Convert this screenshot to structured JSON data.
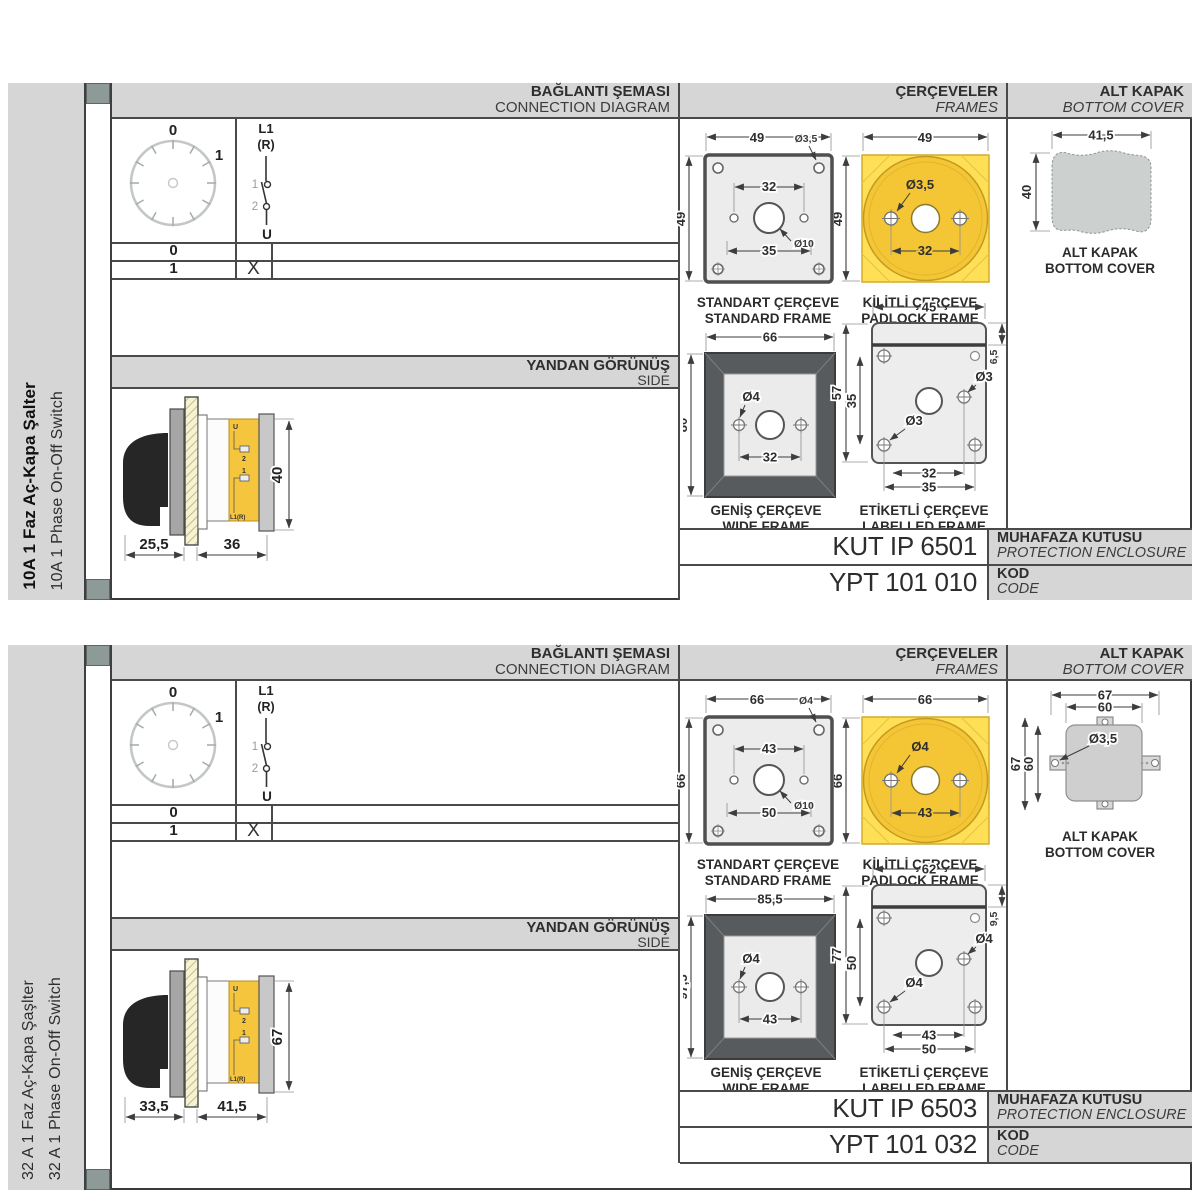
{
  "colors": {
    "accent_yellow": "#f4c636",
    "panel_gray": "#d6d6d6",
    "strip_slate": "#8e9a98",
    "line_dark": "#3f3f3f"
  },
  "sections": [
    {
      "sidebar": {
        "title_tr": "10A 1 Faz Aç-Kapa Şalter",
        "title_en": "10A 1 Phase On-Off Switch",
        "title_bold": true
      },
      "headers": {
        "connection_tr": "BAĞLANTI ŞEMASI",
        "connection_en": "CONNECTION DIAGRAM",
        "frames_tr": "ÇERÇEVELER",
        "frames_en": "FRAMES",
        "cover_tr": "ALT KAPAK",
        "cover_en": "BOTTOM COVER",
        "side_tr": "YANDAN GÖRÜNÜŞ",
        "side_en": "SIDE"
      },
      "diagram": {
        "dial": {
          "pos0": "0",
          "pos1": "1"
        },
        "switch": {
          "top": "L1",
          "top2": "(R)",
          "c1": "1",
          "c2": "2",
          "bottom": "U"
        },
        "table": [
          {
            "pos": "0",
            "mark": ""
          },
          {
            "pos": "1",
            "mark": "X"
          }
        ]
      },
      "side_view": {
        "dim_handle": "25,5",
        "dim_depth": "36",
        "dim_height": "40",
        "labels": {
          "u": "U",
          "t2": "2",
          "t1": "1",
          "l1r": "L1(R)"
        }
      },
      "frames": {
        "standard": {
          "caption_tr": "STANDART ÇERÇEVE",
          "caption_en": "STANDARD FRAME",
          "dim_width": "49",
          "dim_height": "49",
          "screw_dia": "Ø3,5",
          "dim_holes": "32",
          "center_dia": "Ø10",
          "dim_outer_holes": "35"
        },
        "padlock": {
          "caption_tr": "KİLİTLİ ÇERÇEVE",
          "caption_en": "PADLOCK FRAME",
          "dim_width": "49",
          "dim_height": "49",
          "screw_dia": "Ø3,5",
          "dim_holes": "32"
        },
        "wide": {
          "caption_tr": "GENİŞ ÇERÇEVE",
          "caption_en": "WIDE FRAME",
          "dim_width": "66",
          "dim_height": "80",
          "screw_dia": "Ø4",
          "dim_holes": "32"
        },
        "labelled": {
          "caption_tr": "ETİKETLİ ÇERÇEVE",
          "caption_en": "LABELLED FRAME",
          "dim_width": "45",
          "dim_strip": "6,5",
          "dim_height": "57",
          "dim_holes_v": "35",
          "screw_dia_right": "Ø3",
          "screw_dia_left": "Ø3",
          "dim_holes": "32",
          "dim_outer_holes": "35"
        }
      },
      "bottom_cover": {
        "variant": 1,
        "caption_tr": "ALT KAPAK",
        "caption_en": "BOTTOM COVER",
        "dim_width": "41,5",
        "dim_height": "40",
        "dim_width_outer": "",
        "dim_width_inner": "",
        "dim_height_outer": "",
        "dim_height_inner": "",
        "screw_dia": ""
      },
      "codes": {
        "enclosure_value": "KUT IP 6501",
        "enclosure_label_tr": "MUHAFAZA KUTUSU",
        "enclosure_label_en": "PROTECTION ENCLOSURE",
        "code_value": "YPT 101 010",
        "code_label_tr": "KOD",
        "code_label_en": "CODE"
      }
    },
    {
      "sidebar": {
        "title_tr": "32 A 1 Faz Aç-Kapa Şaşlter",
        "title_en": "32 A 1 Phase On-Off Switch",
        "title_bold": false
      },
      "headers": {
        "connection_tr": "BAĞLANTI ŞEMASI",
        "connection_en": "CONNECTION DIAGRAM",
        "frames_tr": "ÇERÇEVELER",
        "frames_en": "FRAMES",
        "cover_tr": "ALT KAPAK",
        "cover_en": "BOTTOM COVER",
        "side_tr": "YANDAN GÖRÜNÜŞ",
        "side_en": "SIDE"
      },
      "diagram": {
        "dial": {
          "pos0": "0",
          "pos1": "1"
        },
        "switch": {
          "top": "L1",
          "top2": "(R)",
          "c1": "1",
          "c2": "2",
          "bottom": "U"
        },
        "table": [
          {
            "pos": "0",
            "mark": ""
          },
          {
            "pos": "1",
            "mark": "X"
          }
        ]
      },
      "side_view": {
        "dim_handle": "33,5",
        "dim_depth": "41,5",
        "dim_height": "67",
        "labels": {
          "u": "U",
          "t2": "2",
          "t1": "1",
          "l1r": "L1(R)"
        }
      },
      "frames": {
        "standard": {
          "caption_tr": "STANDART ÇERÇEVE",
          "caption_en": "STANDARD FRAME",
          "dim_width": "66",
          "dim_height": "66",
          "screw_dia": "Ø4",
          "dim_holes": "43",
          "center_dia": "Ø10",
          "dim_outer_holes": "50"
        },
        "padlock": {
          "caption_tr": "KİLİTLİ ÇERÇEVE",
          "caption_en": "PADLOCK FRAME",
          "dim_width": "66",
          "dim_height": "66",
          "screw_dia": "Ø4",
          "dim_holes": "43"
        },
        "wide": {
          "caption_tr": "GENİŞ ÇERÇEVE",
          "caption_en": "WIDE FRAME",
          "dim_width": "85,5",
          "dim_height": "97,5",
          "screw_dia": "Ø4",
          "dim_holes": "43"
        },
        "labelled": {
          "caption_tr": "ETİKETLİ ÇERÇEVE",
          "caption_en": "LABELLED FRAME",
          "dim_width": "62",
          "dim_strip": "9,5",
          "dim_height": "77",
          "dim_holes_v": "50",
          "screw_dia_right": "Ø4",
          "screw_dia_left": "Ø4",
          "dim_holes": "43",
          "dim_outer_holes": "50"
        }
      },
      "bottom_cover": {
        "variant": 2,
        "caption_tr": "ALT KAPAK",
        "caption_en": "BOTTOM COVER",
        "dim_width": "",
        "dim_height": "",
        "dim_width_outer": "67",
        "dim_width_inner": "60",
        "dim_height_outer": "67",
        "dim_height_inner": "60",
        "screw_dia": "Ø3,5"
      },
      "codes": {
        "enclosure_value": "KUT IP 6503",
        "enclosure_label_tr": "MUHAFAZA KUTUSU",
        "enclosure_label_en": "PROTECTION ENCLOSURE",
        "code_value": "YPT 101 032",
        "code_label_tr": "KOD",
        "code_label_en": "CODE"
      }
    }
  ]
}
